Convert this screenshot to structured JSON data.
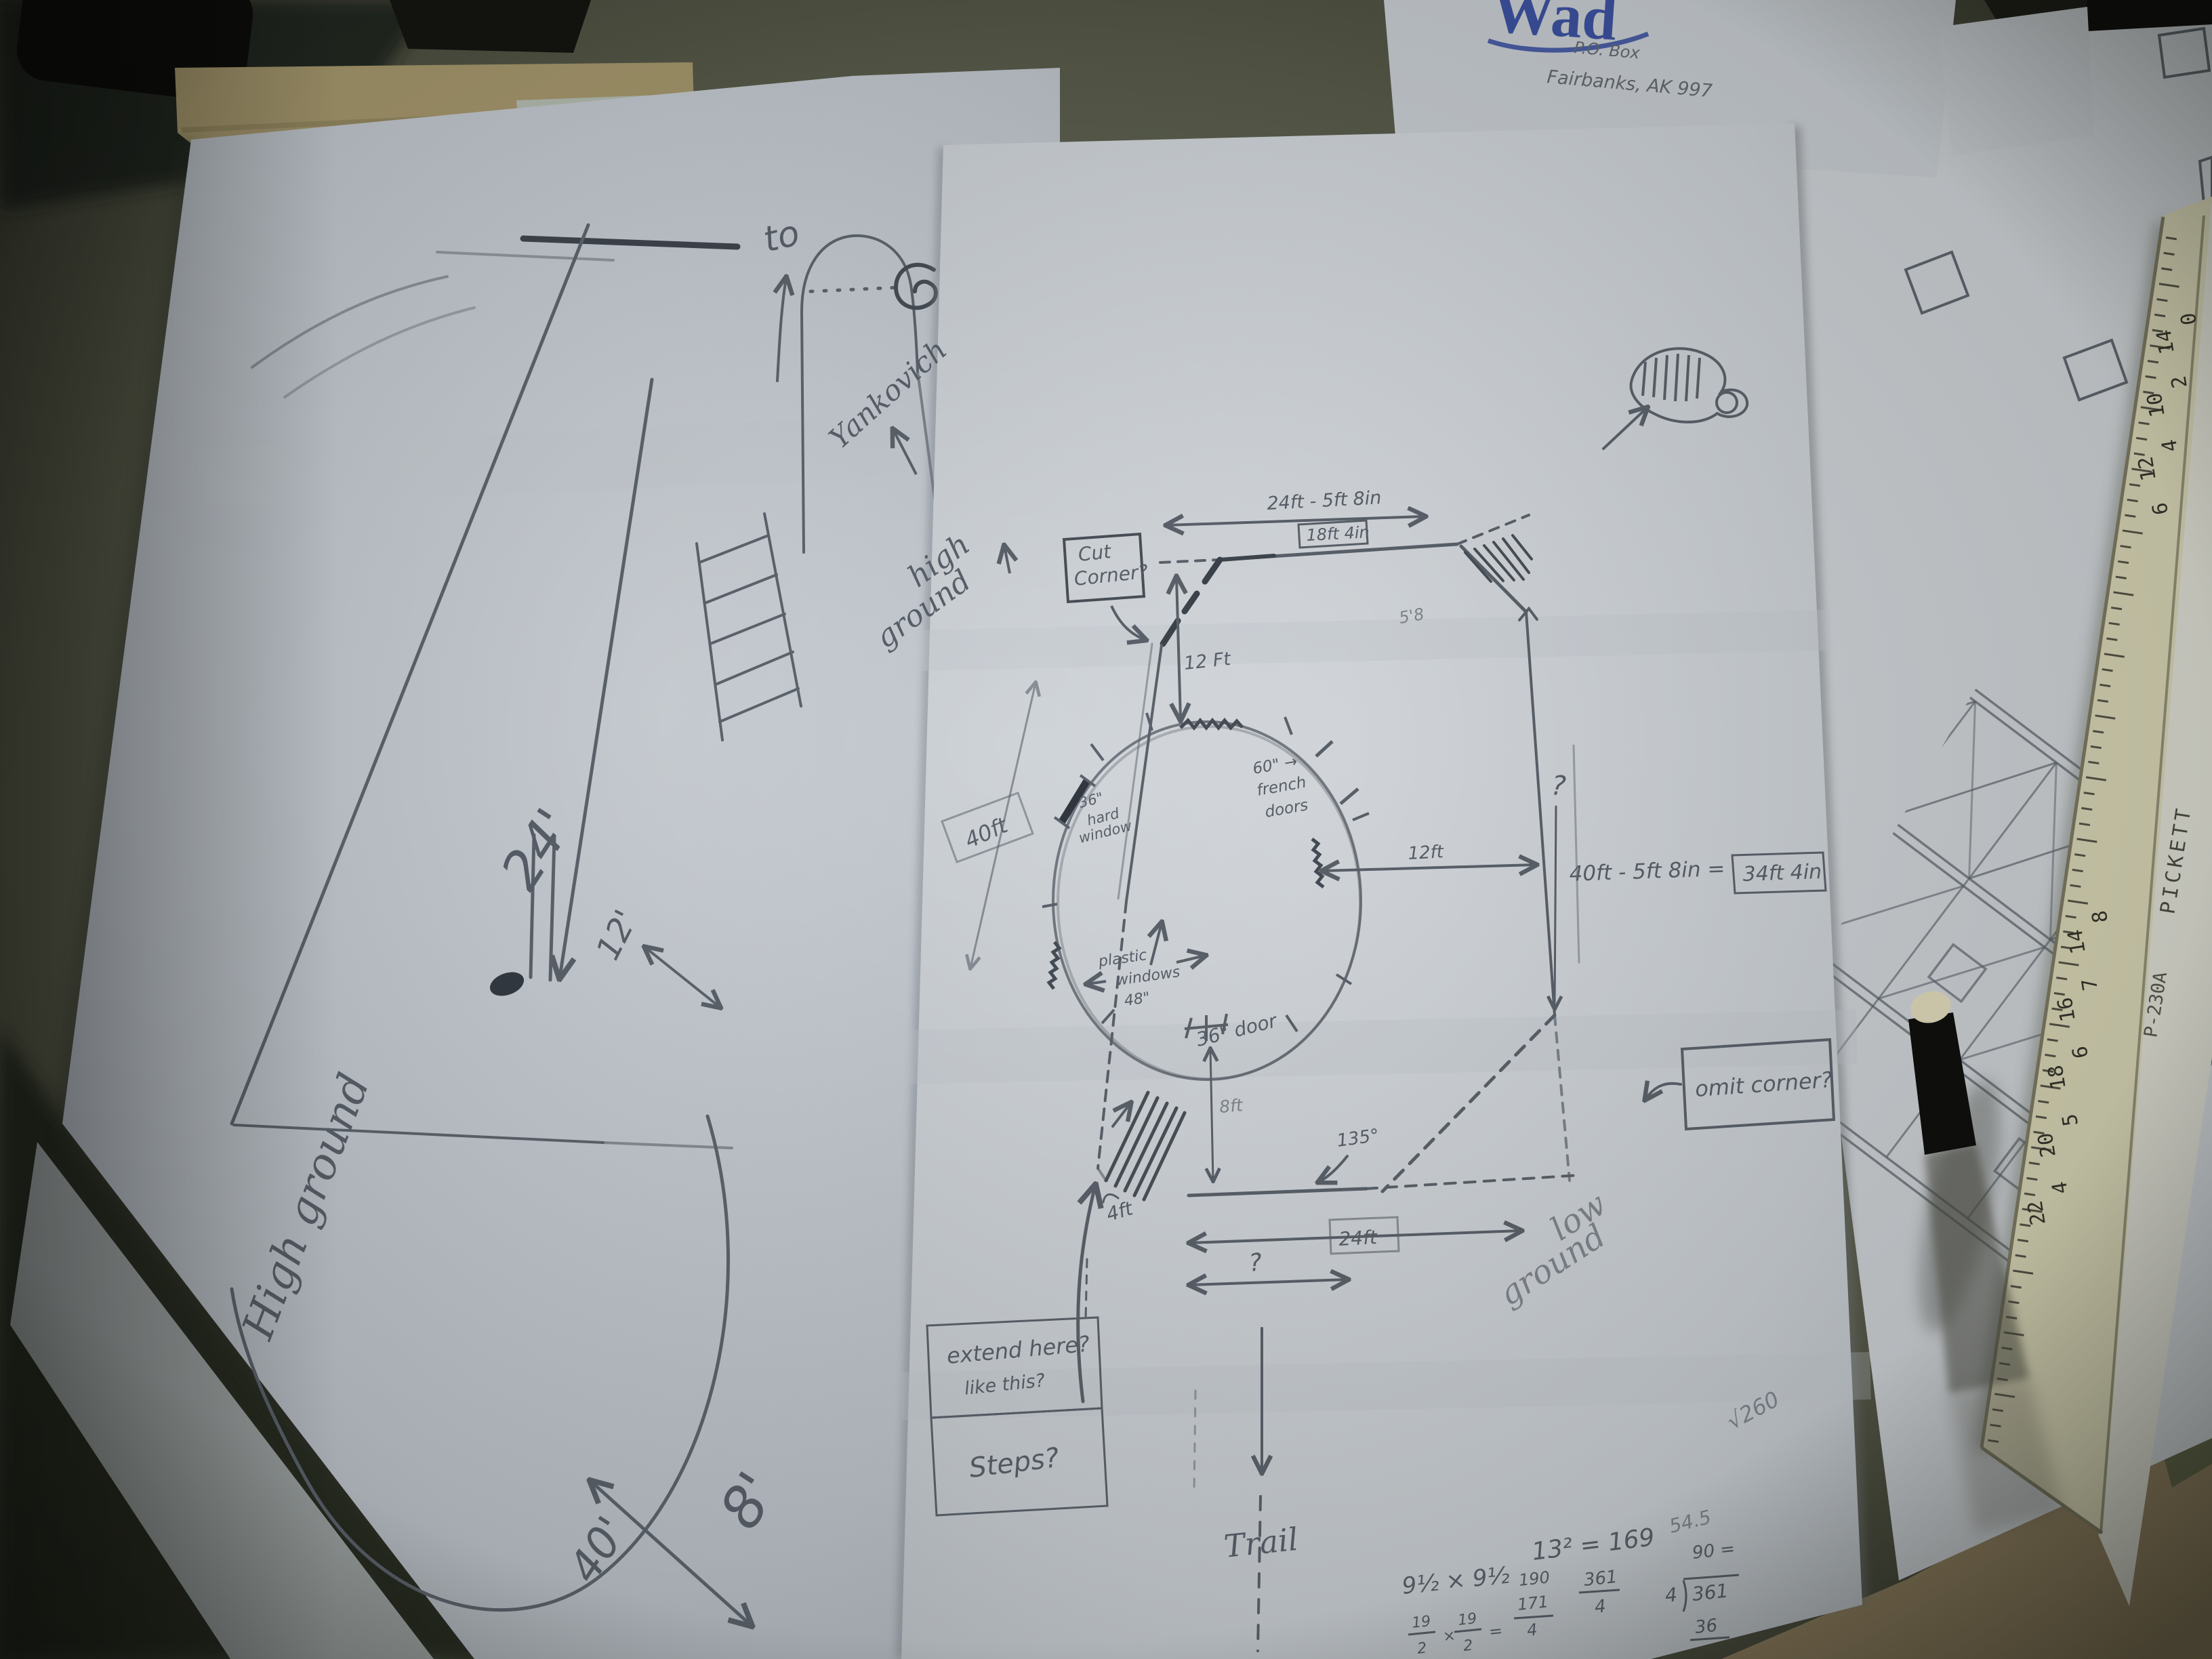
{
  "scene": {
    "description": "Photograph of hand-drawn floor-plan sketches on a desk with ruler and pen"
  },
  "letterhead": {
    "logo": "Wad",
    "po_box": "P.O. Box",
    "city": "Fairbanks, AK 997"
  },
  "left_sketch": {
    "to": "to",
    "dim_24": "24'",
    "dim_12": "12'",
    "dim_8": "8'",
    "dim_40": "40'",
    "high_ground": "High ground"
  },
  "plan": {
    "yankovich": "Yankovich",
    "high_ground": [
      "high",
      "ground"
    ],
    "cut_corner": [
      "Cut",
      "Corner?"
    ],
    "top_dim": "24ft - 5ft 8in",
    "top_dim_result": "18ft 4in",
    "corner_note": "5'8",
    "dim_12ft_top": "12 Ft",
    "dim_40ft_left": "40ft",
    "dim_12ft_right": "12ft",
    "question_right": "?",
    "right_eq": "40ft - 5ft 8in =",
    "right_eq_result": "34ft 4in",
    "window_36": [
      "36\"",
      "hard",
      "window"
    ],
    "french_doors": [
      "60\" →",
      "french",
      "doors"
    ],
    "plastic_windows": [
      "plastic",
      "windows",
      "48\""
    ],
    "door_36": "36\" door",
    "omit_corner": "omit corner?",
    "angle_135": "135°",
    "dim_8ft": "8ft",
    "dim_4ft": "4ft",
    "dim_24ft": "24ft",
    "question_bottom": "?",
    "extend": [
      "extend here?",
      "like this?"
    ],
    "steps": "Steps?",
    "trail": "Trail",
    "low_ground": [
      "low",
      "ground"
    ],
    "math": {
      "square": "13² = 169",
      "approx": "54.5",
      "root": "√260",
      "halves": "9½ × 9½",
      "times": "×",
      "frac19": [
        "19",
        "2",
        "19",
        "2",
        "="
      ],
      "stack": [
        "190",
        "171",
        "4"
      ],
      "frac361": [
        "361",
        "4"
      ],
      "ninety": "90 =",
      "div_divisor": "4",
      "div_dividend": "361",
      "div_result": "36"
    }
  },
  "ruler": {
    "brand": "PICKETT",
    "model": "P-230A",
    "upper": [
      "0",
      "14",
      "2",
      "10",
      "4",
      "12",
      "6"
    ],
    "lower": [
      "8",
      "14",
      "7",
      "16",
      "6",
      "18",
      "5",
      "20",
      "4",
      "22"
    ]
  }
}
